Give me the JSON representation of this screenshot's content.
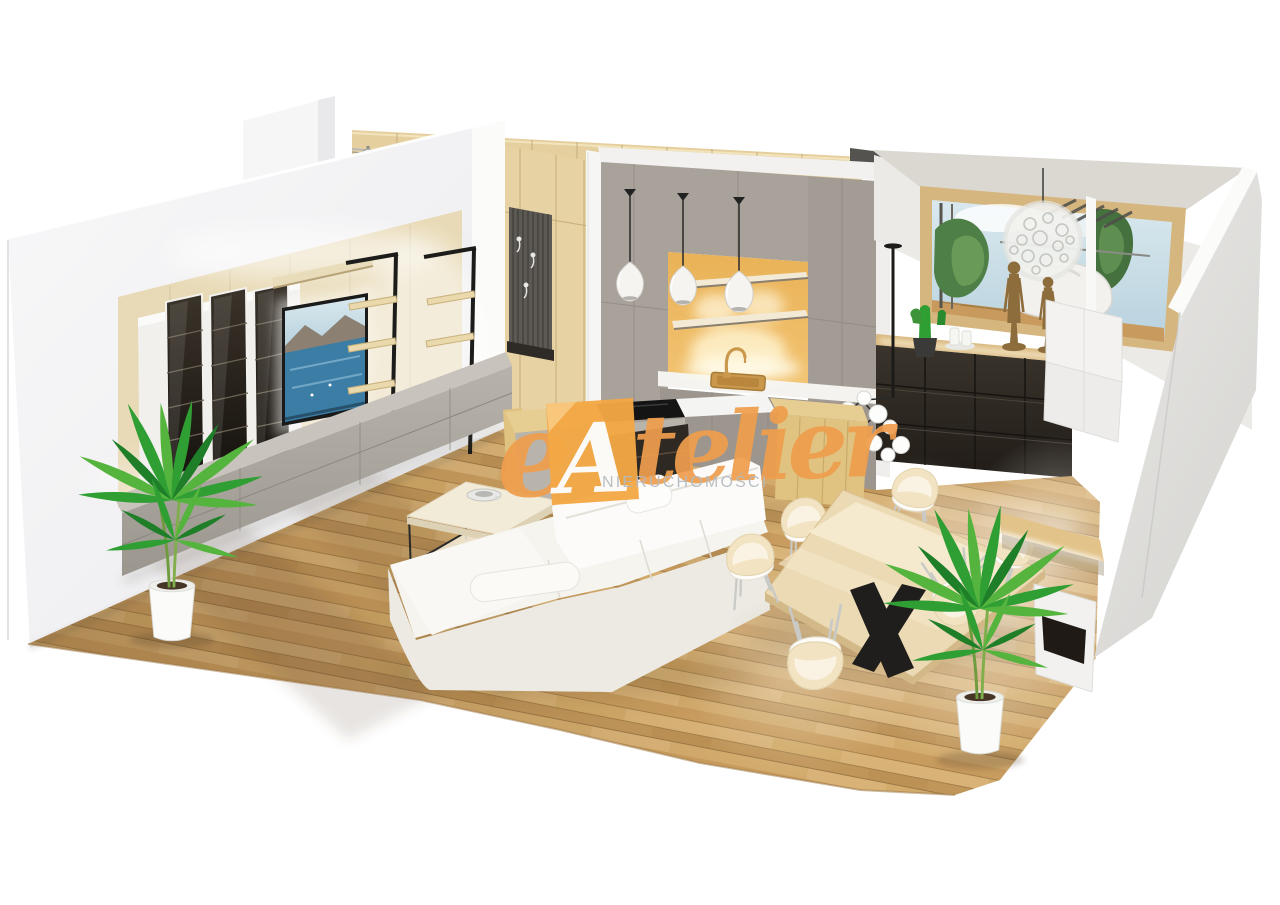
{
  "meta": {
    "title": "3D apartment interior visualization",
    "view": "isometric cutaway floor-plan render"
  },
  "watermark": {
    "prefix_letter": "e",
    "monogram_letter": "A",
    "brand_script": "telier",
    "brand_full": "eAtelier",
    "subtitle": "NIERUCHOMOŚCI",
    "accent_color": "#EF9E4D",
    "monogram_bg_color": "#F4A845",
    "monogram_fold_color": "#F8C87E",
    "monogram_letter_color": "#FDFDFC",
    "subtitle_color": "#B4BAC0"
  },
  "palette": {
    "background": "#FFFFFF",
    "wall_white": "#F4F4F6",
    "wall_bright": "#FBFBFA",
    "wall_right_gray": "#D6D5D2",
    "ceiling_gray": "#DBD7D1",
    "floor_wood": "#CDA263",
    "floor_gap": "#A57F49",
    "panel_wood": "#E8DAB6",
    "wardrobe_wood": "#E5CF9E",
    "hallway_slat_gray": "#5C5954",
    "kitchen_gray": "#A9A29A",
    "backsplash_amber": "#F2C372",
    "counter_white": "#F4F3F0",
    "island_wood": "#E0C380",
    "cabinet_dark_brown": "#2E2923",
    "sideboard_gray": "#ABA7A0",
    "sofa_white": "#F6F4EF",
    "table_wood": "#EBDAB4",
    "chair_cream": "#F2E3C2",
    "plant_green": "#2F9E33",
    "pot_white": "#FBFBFA",
    "metal_black": "#1F1E1C",
    "brass_gold": "#C9984C",
    "tv_sea_blue": "#3C7DA6",
    "window_frame_wood": "#D6B67F"
  },
  "scene": {
    "rooms": [
      {
        "name": "living-room",
        "objects": [
          "media-wall-panel",
          "tv-screen",
          "glass-display-cabinets",
          "ladder-shelves",
          "gray-sideboard",
          "corner-sofa",
          "coffee-table",
          "decor-bowl",
          "palm-plant"
        ]
      },
      {
        "name": "kitchen",
        "objects": [
          "tall-gray-cabinets",
          "amber-backsplash-niche",
          "floating-shelves",
          "gold-faucet",
          "gold-sink",
          "island-with-cooktop",
          "pendant-lamps"
        ]
      },
      {
        "name": "dining-area",
        "objects": [
          "wood-table",
          "black-x-base",
          "cream-chairs",
          "palm-plant"
        ]
      },
      {
        "name": "hallway",
        "objects": [
          "wardrobe-cabinets",
          "coat-slat-panel",
          "wall-hooks",
          "bench",
          "track-spotlights"
        ]
      },
      {
        "name": "window-corner",
        "objects": [
          "picture-window",
          "dandelion-pendant-lamp",
          "cactus-pot",
          "bronze-figurines",
          "candles",
          "dark-sideboard",
          "led-desk"
        ]
      }
    ]
  }
}
